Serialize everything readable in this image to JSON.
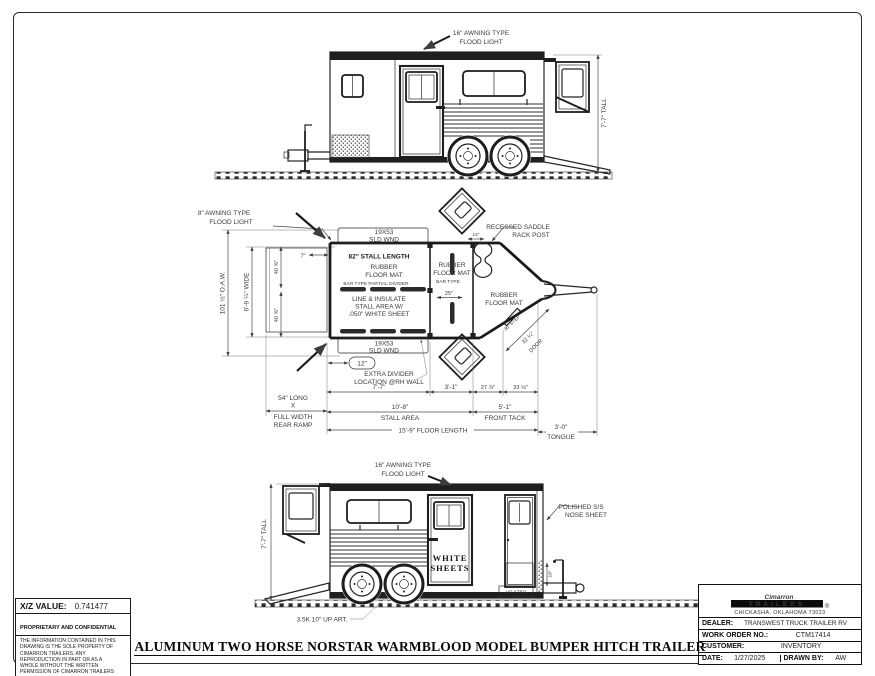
{
  "sheet": {
    "title": "ALUMINUM TWO HORSE NORSTAR WARMBLOOD MODEL BUMPER HITCH TRAILER"
  },
  "info_box": {
    "xz_label": "X/Z VALUE:",
    "xz_value": "0.741477",
    "confidential_title": "PROPRIETARY AND CONFIDENTIAL",
    "confidential_body": "THE INFORMATION CONTAINED IN THIS DRAWING IS THE SOLE PROPERTY OF CIMARRON TRAILERS.  ANY REPRODUCTION IN PART OR AS A WHOLE WITHOUT THE WRITTEN PERMISSION OF CIMARRON TRAILERS IS PROHIBITED."
  },
  "title_block": {
    "brand": "Cimarron",
    "brand_sub": "TRAILERS",
    "registered": "®",
    "address": "CHICKASHA, OKLAHOMA 73023",
    "dealer_label": "DEALER:",
    "dealer": "TRANSWEST TRUCK TRAILER RV",
    "work_order_label": "WORK ORDER NO.:",
    "work_order": "CTM17414",
    "customer_label": "CUSTOMER:",
    "customer": "INVENTORY",
    "date_label": "DATE:",
    "date": "1/27/2025",
    "drawn_by_label": "DRAWN BY:",
    "drawn_by": "AW"
  },
  "top_view": {
    "flood_light_1": "16\" AWNING TYPE",
    "flood_light_2": "FLOOD LIGHT",
    "tall_dim": "7'-7\" TALL"
  },
  "plan_view": {
    "flood_light_1": "8\" AWNING TYPE",
    "flood_light_2": "FLOOD LIGHT",
    "oaw_dim": "101 ½\" O.A.W.",
    "wide_dim": "6'-9 ¼\" WIDE",
    "stall_width_1": "40 ⅝\"",
    "stall_width_2": "40 ⅝\"",
    "seven_dim": "7\"",
    "wnd_top_1": "19X53",
    "wnd_top_2": "SLD WND",
    "wnd_bottom_1": "19X53",
    "wnd_bottom_2": "SLD WND",
    "stall_length": "82\" STALL LENGTH",
    "mat1_1": "RUBBER",
    "mat1_2": "FLOOR MAT",
    "divider_label": "BAR TYPE PARTIAL DIVIDER",
    "line_insulate_1": "LINE & INSULATE",
    "line_insulate_2": "STALL AREA W/",
    "line_insulate_3": ".050\" WHITE SHEET",
    "mat2_1": "RUBBER",
    "mat2_2": "FLOOR MAT",
    "bar_type": "BAR TYPE",
    "dim_25": "25\"",
    "saddle_1": "RECESSED SADDLE",
    "saddle_2": "RACK POST",
    "dim_14": "14\"",
    "mat3_1": "RUBBER",
    "mat3_2": "FLOOR MAT",
    "step_dim": "36\" STEP",
    "door_dim_1": "32 ¼\"",
    "door_dim_2": "DOOR",
    "dim_12": "12\"",
    "extra_divider_1": "EXTRA DIVIDER",
    "extra_divider_2": "LOCATION @RH WALL",
    "dim_7_7": "7'-7\"",
    "dim_3_1": "3'-1\"",
    "dim_27": "27 ⅞\"",
    "dim_33": "33 ⅛\"",
    "ramp_1": "54\" LONG",
    "ramp_2": "X",
    "ramp_3": "FULL WIDTH",
    "ramp_4": "REAR RAMP",
    "stall_area_1": "10'-8\"",
    "stall_area_2": "STALL AREA",
    "front_tack_1": "5'-1\"",
    "front_tack_2": "FRONT TACK",
    "floor_length": "15'-9\" FLOOR LENGTH",
    "tongue_1": "3'-0\"",
    "tongue_2": "TONGUE"
  },
  "bottom_view": {
    "flood_light_1": "16\" AWNING TYPE",
    "flood_light_2": "FLOOD LIGHT",
    "tall_dim": "7'-7\" TALL",
    "nose_1": "POLISHED S/S",
    "nose_2": "NOSE SHEET",
    "white_sheets_1": "WHITE",
    "white_sheets_2": "SHEETS",
    "up_step": "UP STEP",
    "dim_18": "18\"",
    "axle": "3.5K 10\" UP ART."
  }
}
